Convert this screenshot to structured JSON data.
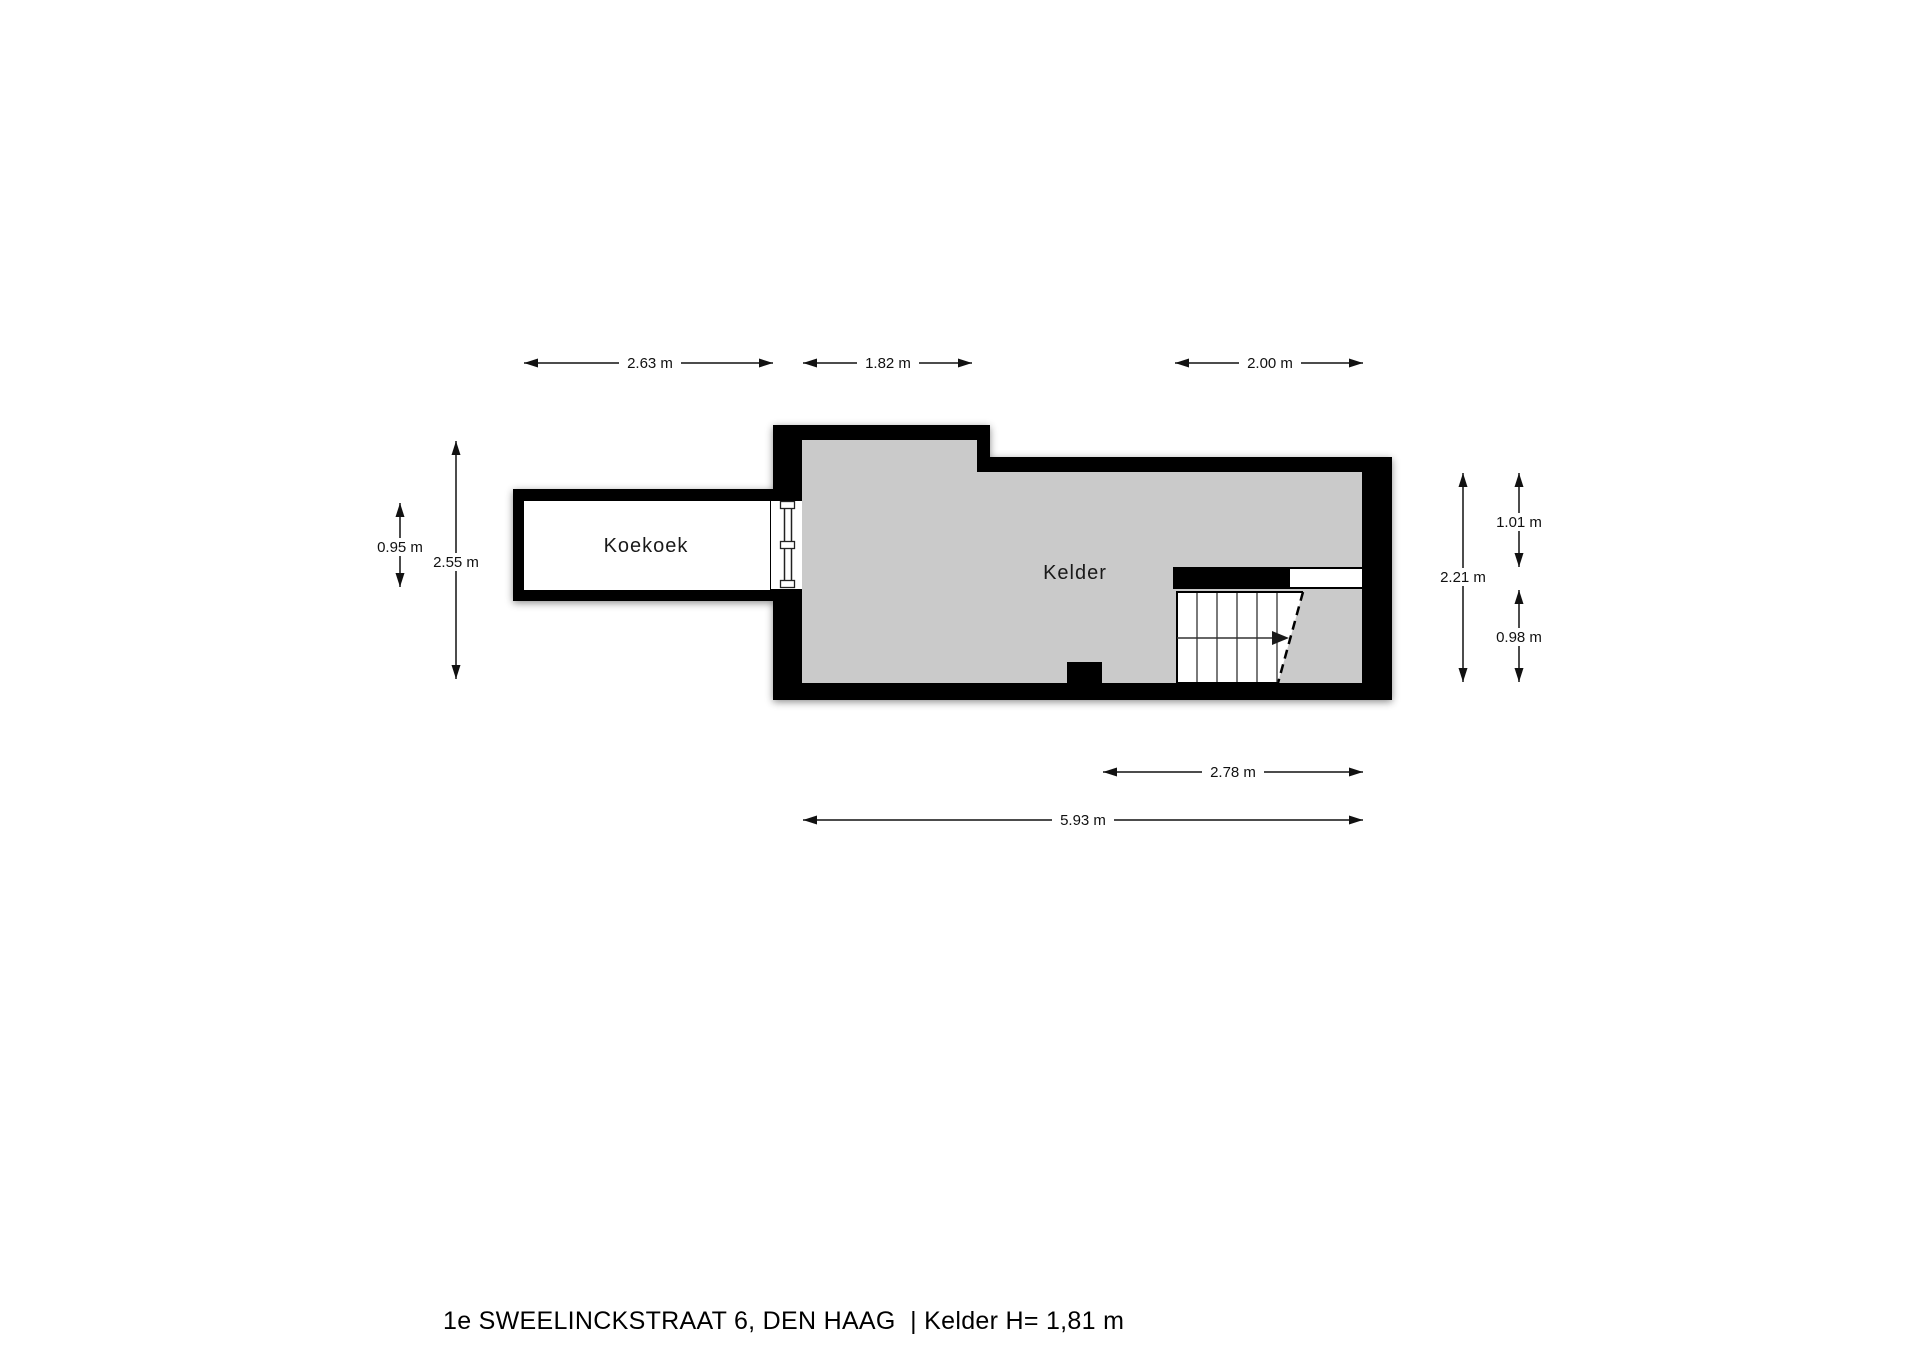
{
  "floorplan": {
    "title": "1e SWEELINCKSTRAAT 6, DEN HAAG  | Kelder H= 1,81 m",
    "rooms": [
      {
        "name": "Koekoek"
      },
      {
        "name": "Kelder"
      }
    ],
    "dimensions": {
      "top": [
        "2.63 m",
        "1.82 m",
        "2.00 m"
      ],
      "left": [
        "0.95 m",
        "2.55 m"
      ],
      "right": [
        "2.21 m",
        "1.01 m",
        "0.98 m"
      ],
      "bottom": [
        "2.78 m",
        "5.93 m"
      ]
    },
    "colors": {
      "wall": "#000000",
      "floor": "#cacaca",
      "background": "#ffffff",
      "line": "#111111"
    }
  }
}
